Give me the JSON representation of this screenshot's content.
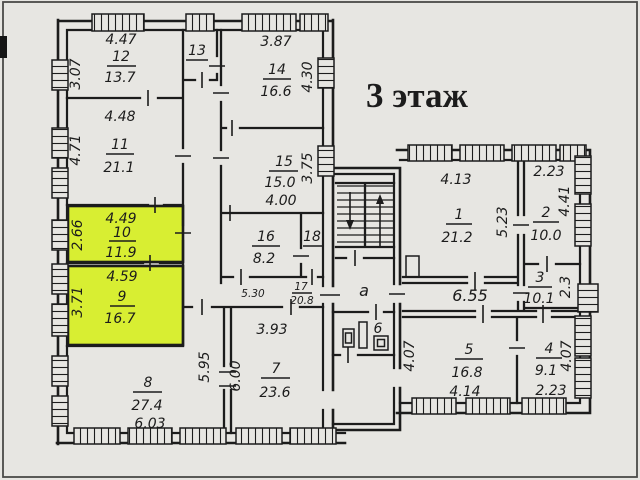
{
  "title": "3 этаж",
  "colors": {
    "paper": "#e7e6e2",
    "ink": "#1c1c1c",
    "highlight": "#d8ee32"
  },
  "rooms": {
    "r1": {
      "num": "1",
      "area": "21.2",
      "w": "4.13",
      "h": "5.23"
    },
    "r2": {
      "num": "2",
      "area": "10.0",
      "w": "2.23",
      "h": "4.41"
    },
    "r3": {
      "num": "3",
      "area": "10.1",
      "h": "2.3"
    },
    "r4": {
      "num": "4",
      "area": "9.1",
      "w": "2.23",
      "h": "4.07"
    },
    "r5": {
      "num": "5",
      "area": "16.8",
      "w": "4.14",
      "h": "4.07"
    },
    "r6": {
      "num": "6"
    },
    "r7": {
      "num": "7",
      "area": "23.6",
      "w": "3.93",
      "h": "6.00"
    },
    "r8": {
      "num": "8",
      "area": "27.4",
      "w": "6.03",
      "h": "5.95"
    },
    "r9": {
      "num": "9",
      "area": "16.7",
      "w": "4.59",
      "h": "3.71"
    },
    "r10": {
      "num": "10",
      "area": "11.9",
      "w": "4.49",
      "h": "2.66"
    },
    "r11": {
      "num": "11",
      "area": "21.1",
      "w": "4.48",
      "h": "4.71"
    },
    "r12": {
      "num": "12",
      "area": "13.7",
      "w": "4.47",
      "h": "3.07"
    },
    "r13": {
      "num": "13"
    },
    "r14": {
      "num": "14",
      "area": "16.6",
      "w": "3.87",
      "h": "4.30"
    },
    "r15": {
      "num": "15",
      "area": "15.0",
      "w": "4.00",
      "h": "3.75"
    },
    "r16": {
      "num": "16",
      "area": "8.2"
    },
    "r17": {
      "num": "17",
      "area": "20.8",
      "w": "5.30"
    },
    "r18": {
      "num": "18"
    },
    "lobby": {
      "label": "а"
    },
    "corridor_right": {
      "w": "6.55"
    }
  },
  "highlighted_rooms": [
    "9",
    "10"
  ]
}
